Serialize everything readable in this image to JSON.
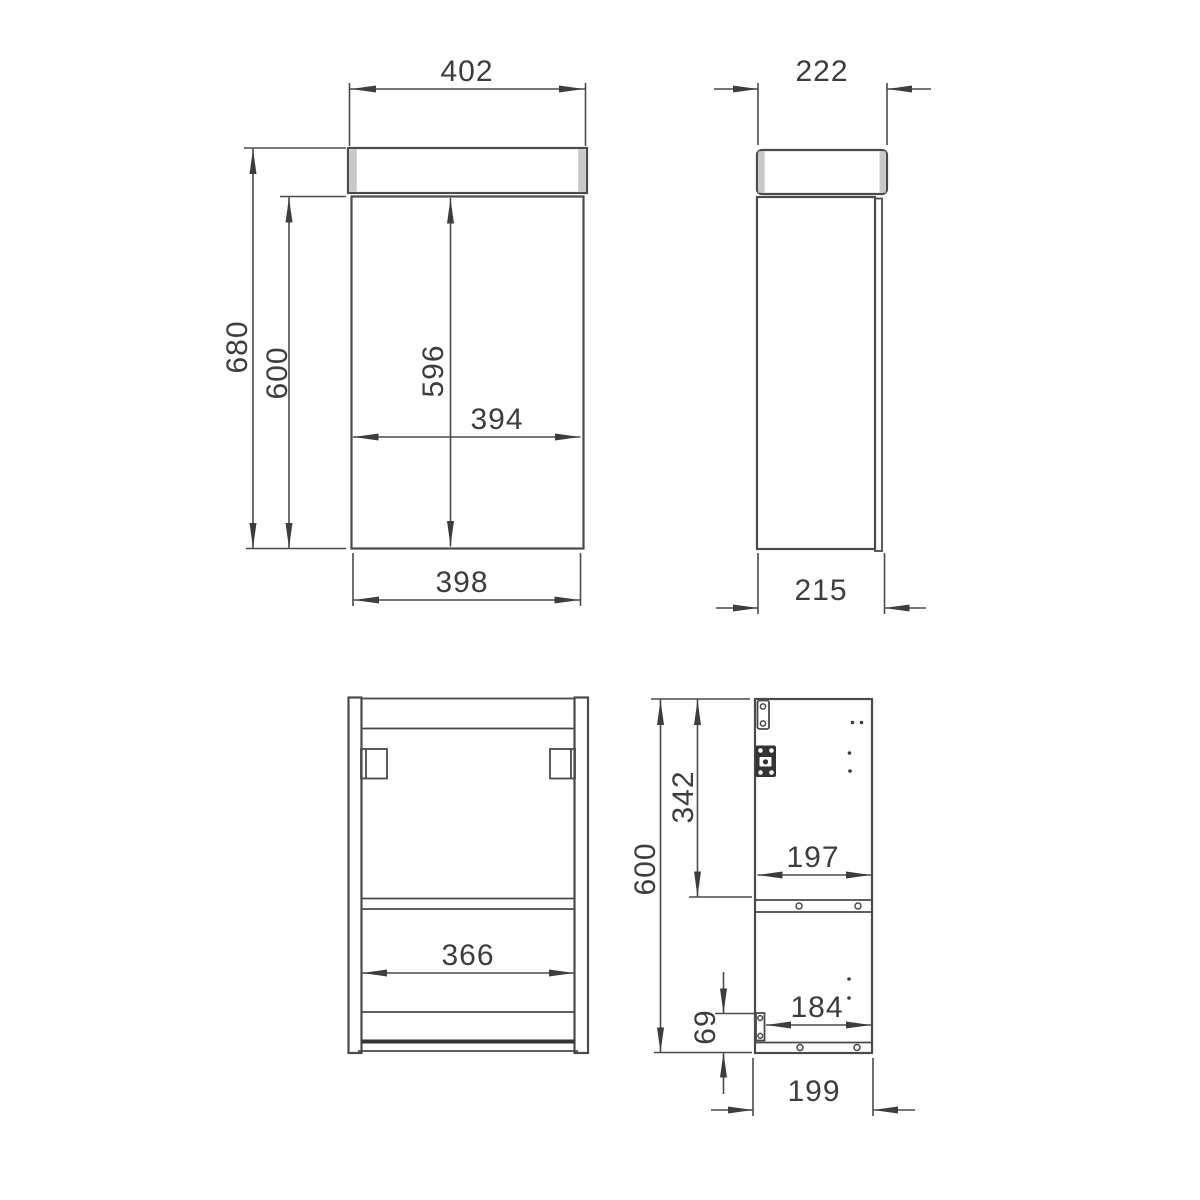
{
  "front_view": {
    "top_width": "402",
    "overall_height": "680",
    "carcass_height": "600",
    "door_height": "596",
    "door_width": "394",
    "bottom_width": "398"
  },
  "side_view": {
    "top_depth": "222",
    "bottom_depth": "215"
  },
  "back_view": {
    "inner_width": "366"
  },
  "interior_view": {
    "overall_height": "600",
    "top_section_height": "342",
    "shelf_inner_width": "197",
    "bottom_inner_width": "184",
    "bottom_section_height": "69",
    "bottom_depth": "199"
  },
  "colors": {
    "line": "#4a4a4a",
    "text": "#3d3d3d",
    "panel_shade": "#c8c8c8",
    "hinge_fill": "#333333",
    "background": "#ffffff"
  }
}
